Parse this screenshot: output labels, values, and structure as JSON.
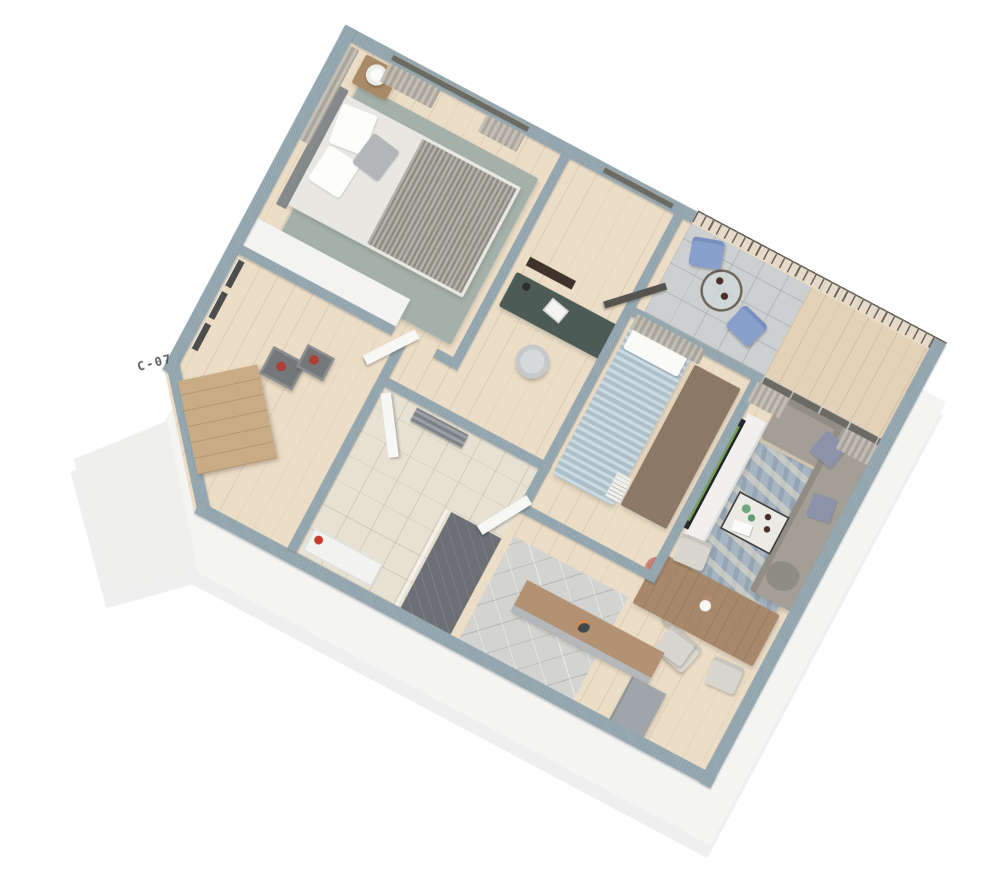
{
  "meta": {
    "type": "isometric-3d-floor-plan-render",
    "background": "#ffffff",
    "view": "cutaway apartment seen from above at an angle"
  },
  "entry": {
    "unit_label": "C-07"
  },
  "palette": {
    "wall_cap": "#90a3ac",
    "wall_face": "#f4f4f2",
    "wood_floor": "#ecddc6",
    "tile_grey": "#d3d4d2",
    "bath_floor": "#e7e1d3",
    "shower_tile": "#6c7074",
    "rug_master": "#a4b1ab",
    "rug_living_blue": "#a7b5c2",
    "rug_bed2_brown": "#8c7965",
    "sofa_grey": "#a39f97",
    "accent_pillow_blue": "#8d92ab",
    "bed2_blue": "#b6cad4",
    "blanket_grey": "#9a978e",
    "desk_green": "#4d5b56",
    "tv_screen_green": "#7cab57",
    "door_wood": "#c9ab85",
    "dining_wood": "#a8886a",
    "counter_wood": "#b29272",
    "vase_red": "#ad3f38",
    "accent_red": "#c63a2f",
    "railing_bronze": "#6d645a",
    "curtain": "#b8b4aa",
    "plant_pink": "#c97f72",
    "label_ink": "#3d4246"
  },
  "rooms": [
    {
      "name": "master-bedroom",
      "floor": "wood",
      "furniture": [
        "double-bed",
        "headboard",
        "pillows",
        "grey-throw-blanket",
        "nightstand",
        "round-lamp",
        "area-rug",
        "wardrobe",
        "curtains",
        "window"
      ]
    },
    {
      "name": "hallway",
      "floor": "wood",
      "furniture": [
        "three-wall-frames",
        "nesting-side-tables",
        "red-vases",
        "entry-door"
      ]
    },
    {
      "name": "study",
      "floor": "wood",
      "furniture": [
        "desk",
        "laptop",
        "desk-lamp",
        "office-chair",
        "wall-art"
      ]
    },
    {
      "name": "bathroom",
      "floor": "beige-tile",
      "furniture": [
        "shower",
        "glass-screen",
        "towel-radiator",
        "vanity",
        "red-accent"
      ]
    },
    {
      "name": "bedroom-2",
      "floor": "wood",
      "furniture": [
        "single-bed-blue",
        "brown-rug",
        "curtain",
        "book-stack"
      ]
    },
    {
      "name": "living-room",
      "floor": "wood",
      "furniture": [
        "l-shaped-sofa",
        "blue-cushions",
        "blue-distressed-rug",
        "coffee-table",
        "green-vases",
        "books",
        "floor-lamp",
        "armchair",
        "tv-console",
        "curved-tv-green-screen",
        "flower-vase"
      ]
    },
    {
      "name": "dining-kitchen",
      "floor": "wood-and-grey-tile",
      "furniture": [
        "dining-table",
        "dining-chairs",
        "centerpiece-vase",
        "kitchen-counter",
        "kitchen-unit",
        "plate-of-food"
      ]
    },
    {
      "name": "balcony",
      "floor": "grey-tile-and-wood",
      "furniture": [
        "wrought-iron-railing",
        "bistro-table",
        "coffee-cups",
        "two-blue-chairs",
        "open-glass-door"
      ]
    }
  ]
}
